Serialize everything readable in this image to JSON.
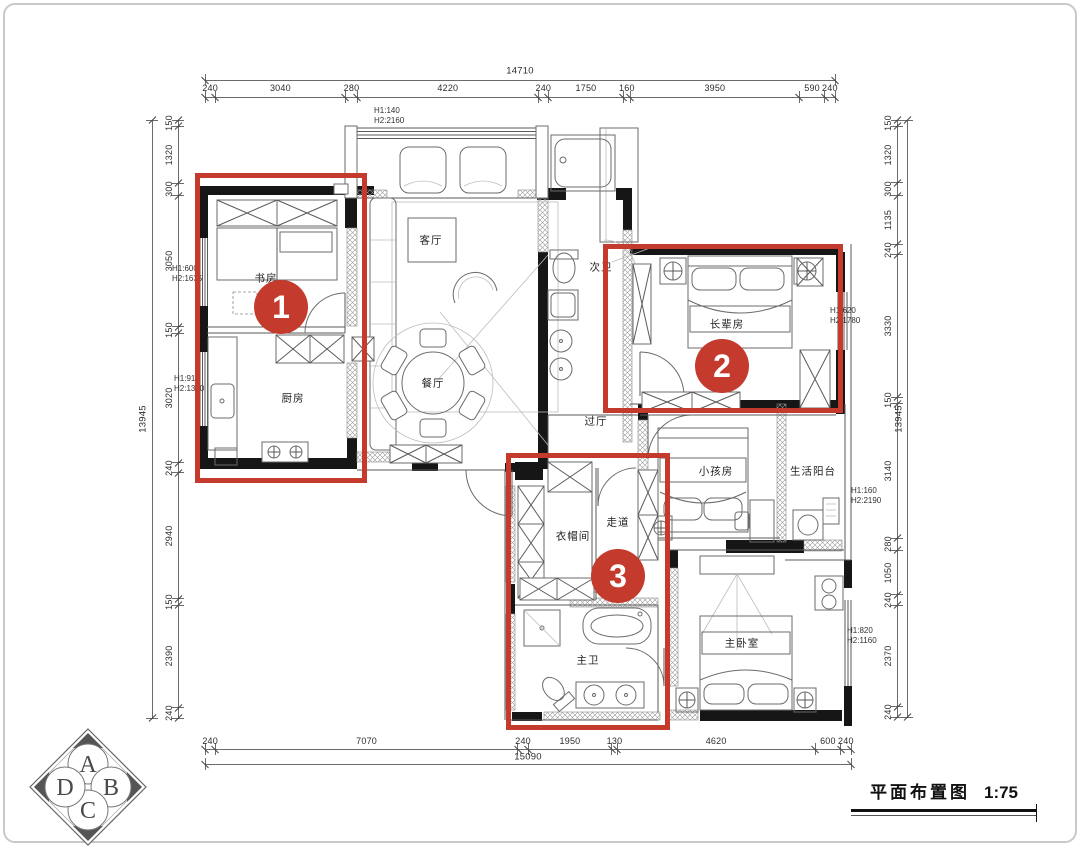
{
  "page": {
    "background": "#ffffff",
    "border_color": "#c9c9c9"
  },
  "drawing": {
    "title": "平面布置图",
    "scale": "1:75"
  },
  "logo": {
    "letters": [
      "A",
      "B",
      "C",
      "D"
    ]
  },
  "colors": {
    "marker_red": "#c43a2c",
    "wall_black": "#161616"
  },
  "dimensions": {
    "top": {
      "total": "14710",
      "segments": [
        240,
        3040,
        280,
        4220,
        240,
        1750,
        160,
        3950,
        590,
        240
      ]
    },
    "bottom": {
      "total": "15090",
      "segments": [
        240,
        7070,
        240,
        1950,
        130,
        4620,
        600,
        240
      ]
    },
    "left": {
      "total": "13945",
      "segments": [
        150,
        1320,
        300,
        3050,
        150,
        3020,
        240,
        2940,
        150,
        2390,
        240
      ]
    },
    "right": {
      "total": "13945",
      "segments": [
        150,
        1320,
        300,
        1135,
        240,
        3330,
        150,
        3140,
        280,
        1050,
        240,
        2370,
        240
      ]
    }
  },
  "rooms": [
    {
      "name": "书房",
      "x": 266,
      "y": 278
    },
    {
      "name": "厨房",
      "x": 293,
      "y": 398
    },
    {
      "name": "客厅",
      "x": 431,
      "y": 240
    },
    {
      "name": "餐厅",
      "x": 433,
      "y": 383
    },
    {
      "name": "次卫",
      "x": 601,
      "y": 267
    },
    {
      "name": "长辈房",
      "x": 727,
      "y": 324
    },
    {
      "name": "过厅",
      "x": 596,
      "y": 421
    },
    {
      "name": "小孩房",
      "x": 716,
      "y": 471
    },
    {
      "name": "生活阳台",
      "x": 813,
      "y": 471
    },
    {
      "name": "衣帽间",
      "x": 573,
      "y": 536
    },
    {
      "name": "走道",
      "x": 618,
      "y": 522
    },
    {
      "name": "主卫",
      "x": 588,
      "y": 660
    },
    {
      "name": "主卧室",
      "x": 742,
      "y": 643
    }
  ],
  "window_annotations": [
    {
      "line1": "H1:140",
      "line2": "H2:2160",
      "x": 374,
      "y": 106
    },
    {
      "line1": "H1:600",
      "line2": "H2:1635",
      "x": 172,
      "y": 264
    },
    {
      "line1": "H1:910",
      "line2": "H2:1350",
      "x": 174,
      "y": 374
    },
    {
      "line1": "H1:620",
      "line2": "H2:1780",
      "x": 830,
      "y": 306
    },
    {
      "line1": "H1:160",
      "line2": "H2:2190",
      "x": 851,
      "y": 486
    },
    {
      "line1": "H1:820",
      "line2": "H2:1160",
      "x": 847,
      "y": 626
    }
  ],
  "markers": {
    "rects": [
      {
        "x": 195,
        "y": 173,
        "w": 172,
        "h": 310
      },
      {
        "x": 603,
        "y": 244,
        "w": 240,
        "h": 169
      },
      {
        "x": 506,
        "y": 453,
        "w": 164,
        "h": 277
      }
    ],
    "badges": [
      {
        "label": "1",
        "x": 281,
        "y": 307
      },
      {
        "label": "2",
        "x": 722,
        "y": 366
      },
      {
        "label": "3",
        "x": 618,
        "y": 576
      }
    ]
  }
}
